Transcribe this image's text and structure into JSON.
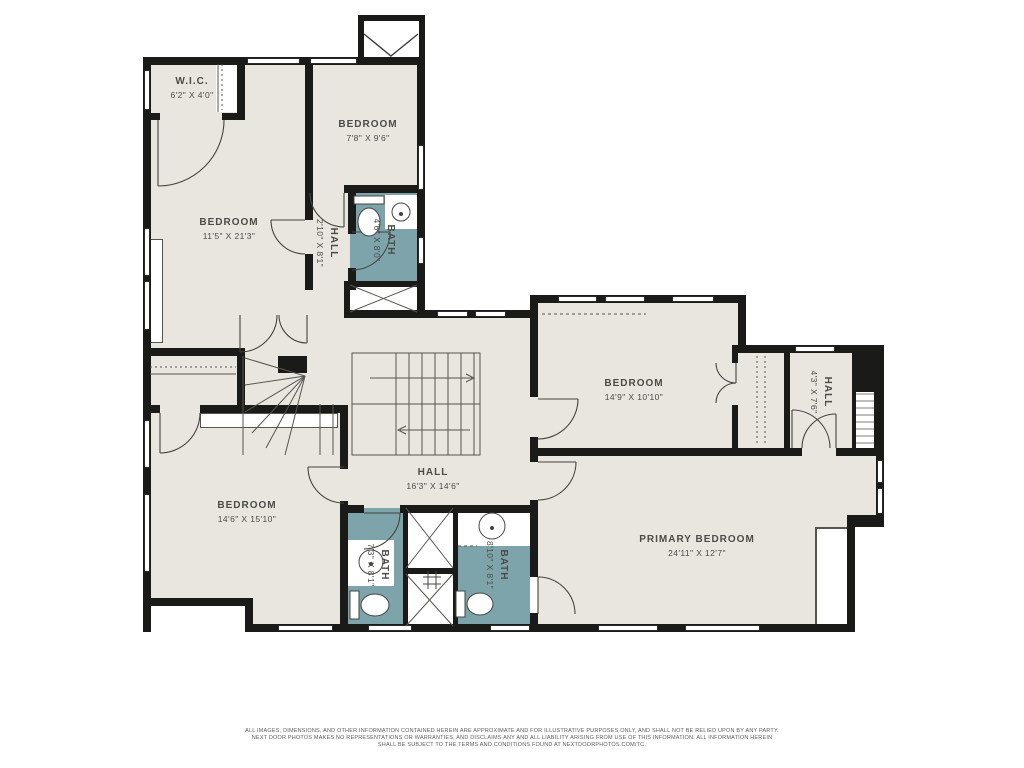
{
  "plan_title": "Second floor residential floor plan",
  "colors": {
    "floor": "#e8e6df",
    "bath_floor": "#7ca4aa",
    "wall": "#1a1a18",
    "label_text": "#4b4b47",
    "background": "#ffffff"
  },
  "rooms": {
    "wic": {
      "name": "W.I.C.",
      "dims": "6'2\" X 4'0\""
    },
    "bedroom_upper_right": {
      "name": "BEDROOM",
      "dims": "7'8\" X 9'6\""
    },
    "bedroom_upper_left": {
      "name": "BEDROOM",
      "dims": "11'5\" X 21'3\""
    },
    "hall_upper": {
      "name": "HALL",
      "dims": "2'10\" X 8'1\""
    },
    "bath_upper": {
      "name": "BATH",
      "dims": "4'6\" X 8'0\""
    },
    "hall_center": {
      "name": "HALL",
      "dims": "16'3\" X 14'6\""
    },
    "bedroom_right": {
      "name": "BEDROOM",
      "dims": "14'9\" X 10'10\""
    },
    "hall_right": {
      "name": "HALL",
      "dims": "4'3\" X 7'6\""
    },
    "bedroom_lower_left": {
      "name": "BEDROOM",
      "dims": "14'6\" X 15'10\""
    },
    "bath_lower_left": {
      "name": "BATH",
      "dims": "7'3\" X 8'1\""
    },
    "bath_lower_center": {
      "name": "BATH",
      "dims": "8'10\" X 8'1\""
    },
    "primary_bedroom": {
      "name": "PRIMARY BEDROOM",
      "dims": "24'11\" X 12'7\""
    }
  },
  "footer": {
    "line1": "ALL IMAGES, DIMENSIONS, AND OTHER INFORMATION CONTAINED HEREIN ARE APPROXIMATE AND FOR ILLUSTRATIVE PURPOSES ONLY, AND SHALL NOT BE RELIED UPON BY ANY PARTY.",
    "line2": "NEXT DOOR PHOTOS MAKES NO REPRESENTATIONS OR WARRANTIES, AND DISCLAIMS ANY AND ALL LIABILITY ARISING FROM USE OF THIS INFORMATION. ALL INFORMATION HEREIN",
    "line3": "SHALL BE SUBJECT TO THE TERMS AND CONDITIONS FOUND AT NEXTDOORPHOTOS.COM/TC."
  }
}
